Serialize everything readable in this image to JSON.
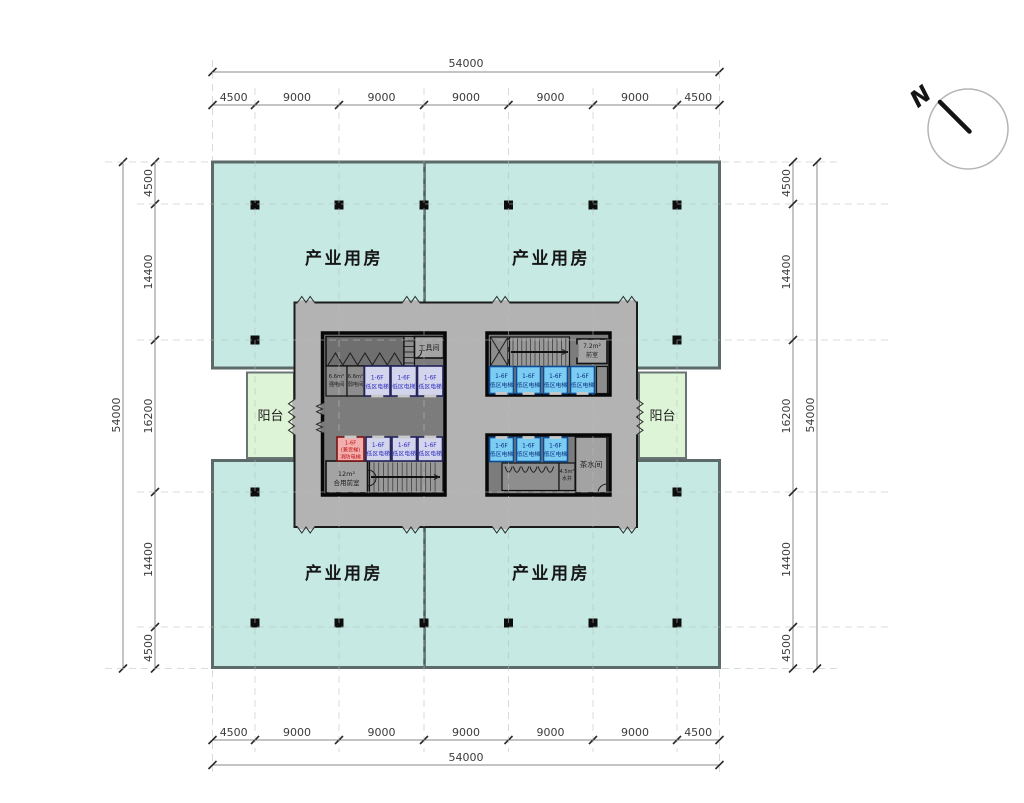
{
  "compass": {
    "north_label": "N"
  },
  "dims": {
    "top": {
      "overall": "54000",
      "segments": [
        "4500",
        "9000",
        "9000",
        "9000",
        "9000",
        "9000",
        "4500"
      ]
    },
    "bottom": {
      "overall": "54000",
      "segments": [
        "4500",
        "9000",
        "9000",
        "9000",
        "9000",
        "9000",
        "4500"
      ]
    },
    "left": {
      "overall": "54000",
      "segments": [
        "4500",
        "14400",
        "16200",
        "14400",
        "4500"
      ]
    },
    "right": {
      "overall": "54000",
      "segments": [
        "4500",
        "14400",
        "16200",
        "14400",
        "4500"
      ]
    }
  },
  "rooms": {
    "industrial": "产业用房",
    "balcony": "阳台",
    "tool_room": "工具间",
    "anteroom_area": "7.2m²",
    "anteroom_name": "前室",
    "shared_anteroom_area": "12m²",
    "shared_anteroom_name": "合用前室",
    "tea_room": "茶水间",
    "water_shaft_area": "4.5m²",
    "water_shaft_name": "水井",
    "elec_strong_area": "6.6m²",
    "elec_strong_name": "强电间",
    "elec_weak_area": "6.6m²",
    "elec_weak_name": "弱电间"
  },
  "elevators": {
    "low_zone": {
      "floors": "1-6F",
      "name": "低区电梯"
    },
    "fire": {
      "floors": "1-6F",
      "note": "(兼货梯)",
      "name": "消防电梯"
    }
  },
  "colors": {
    "industrial_fill": "#c6eae3",
    "balcony_fill": "#def4d7",
    "core_band": "#b3b3b3",
    "core_block": "#7c7c7c",
    "elevator_blue": "#7bcdf4",
    "elevator_blue_text": "#0a2f7c",
    "elevator_lavender": "#d3d5ec",
    "elevator_lavender_text": "#2b2bc0",
    "fire_elevator_fill": "#f3aeae",
    "fire_elevator_text": "#c11414",
    "wall": "#0a0a0a"
  }
}
